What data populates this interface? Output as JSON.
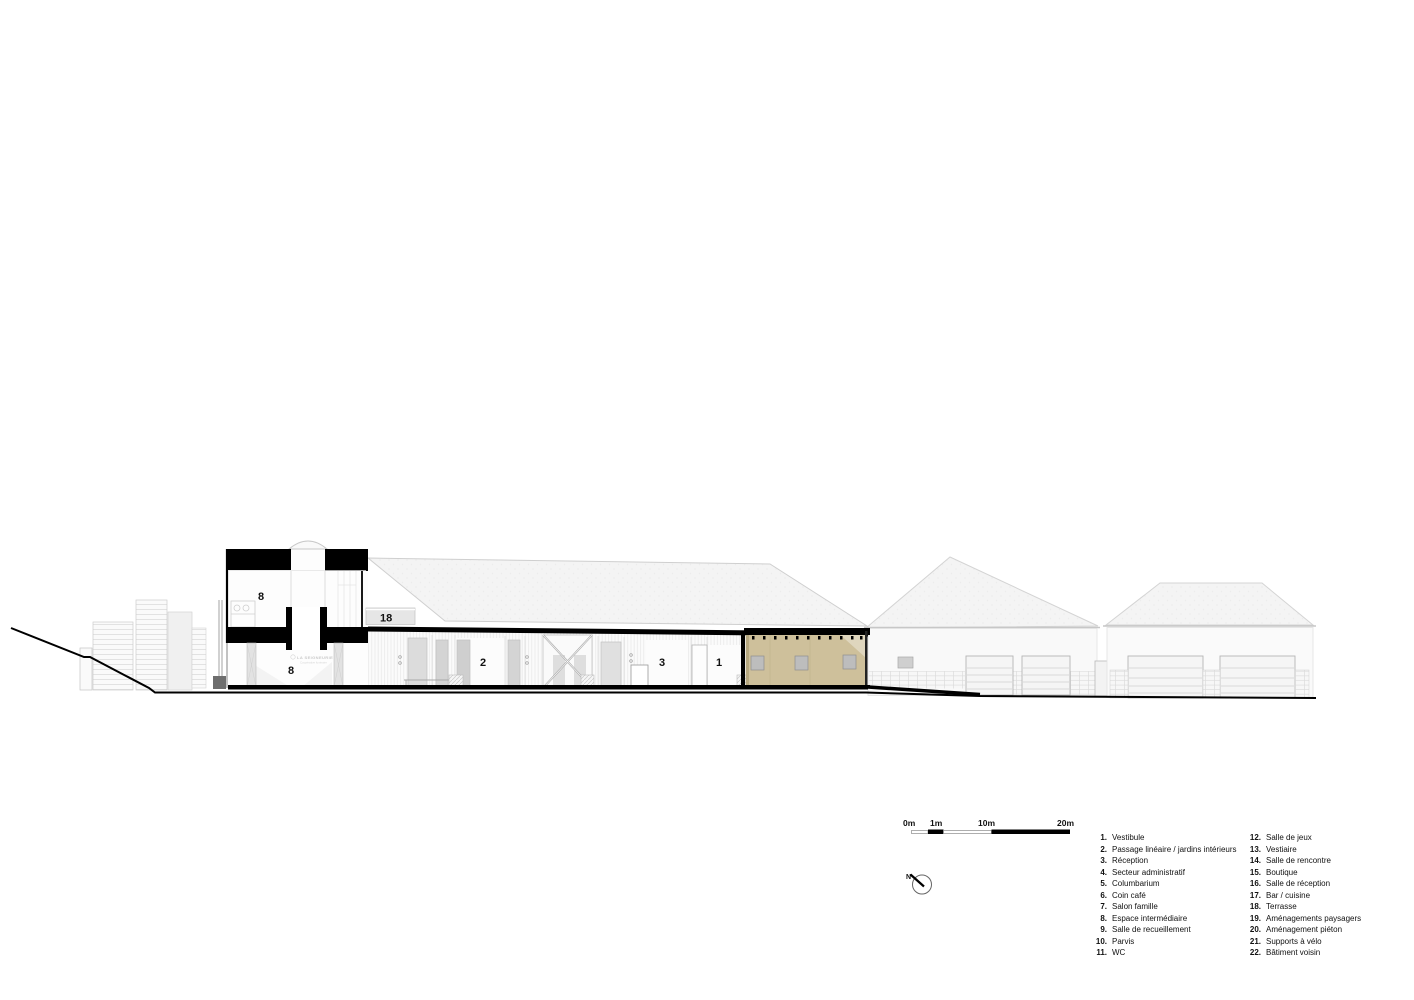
{
  "page": {
    "background": "#ffffff"
  },
  "drawing": {
    "type": "architectural-longitudinal-section",
    "room_labels": {
      "upper_floor": "8",
      "terrace": "18",
      "lower_floor": "8",
      "passage": "2",
      "reception": "3",
      "vestibule": "1"
    },
    "watermark": {
      "line1": "LA SEIGNEURIE",
      "line2": "Coopérative funéraire"
    },
    "colors": {
      "wood": "#cec09b",
      "ink": "#000000",
      "roof": "#f4f4f4"
    }
  },
  "scale_bar": {
    "labels": {
      "zero": "0m",
      "one": "1m",
      "ten": "10m",
      "twenty": "20m"
    }
  },
  "north_arrow": {
    "label": "N"
  },
  "legend": {
    "items": [
      {
        "num": "1.",
        "label": "Vestibule"
      },
      {
        "num": "2.",
        "label": "Passage linéaire / jardins intérieurs"
      },
      {
        "num": "3.",
        "label": "Réception"
      },
      {
        "num": "4.",
        "label": "Secteur administratif"
      },
      {
        "num": "5.",
        "label": "Columbarium"
      },
      {
        "num": "6.",
        "label": "Coin café"
      },
      {
        "num": "7.",
        "label": "Salon famille"
      },
      {
        "num": "8.",
        "label": "Espace intermédiaire"
      },
      {
        "num": "9.",
        "label": "Salle de recueillement"
      },
      {
        "num": "10.",
        "label": "Parvis"
      },
      {
        "num": "11.",
        "label": "WC"
      },
      {
        "num": "12.",
        "label": "Salle de jeux"
      },
      {
        "num": "13.",
        "label": "Vestiaire"
      },
      {
        "num": "14.",
        "label": "Salle de rencontre"
      },
      {
        "num": "15.",
        "label": "Boutique"
      },
      {
        "num": "16.",
        "label": "Salle de réception"
      },
      {
        "num": "17.",
        "label": "Bar / cuisine"
      },
      {
        "num": "18.",
        "label": "Terrasse"
      },
      {
        "num": "19.",
        "label": "Aménagements paysagers"
      },
      {
        "num": "20.",
        "label": "Aménagement piéton"
      },
      {
        "num": "21.",
        "label": "Supports à vélo"
      },
      {
        "num": "22.",
        "label": "Bâtiment voisin"
      }
    ]
  }
}
